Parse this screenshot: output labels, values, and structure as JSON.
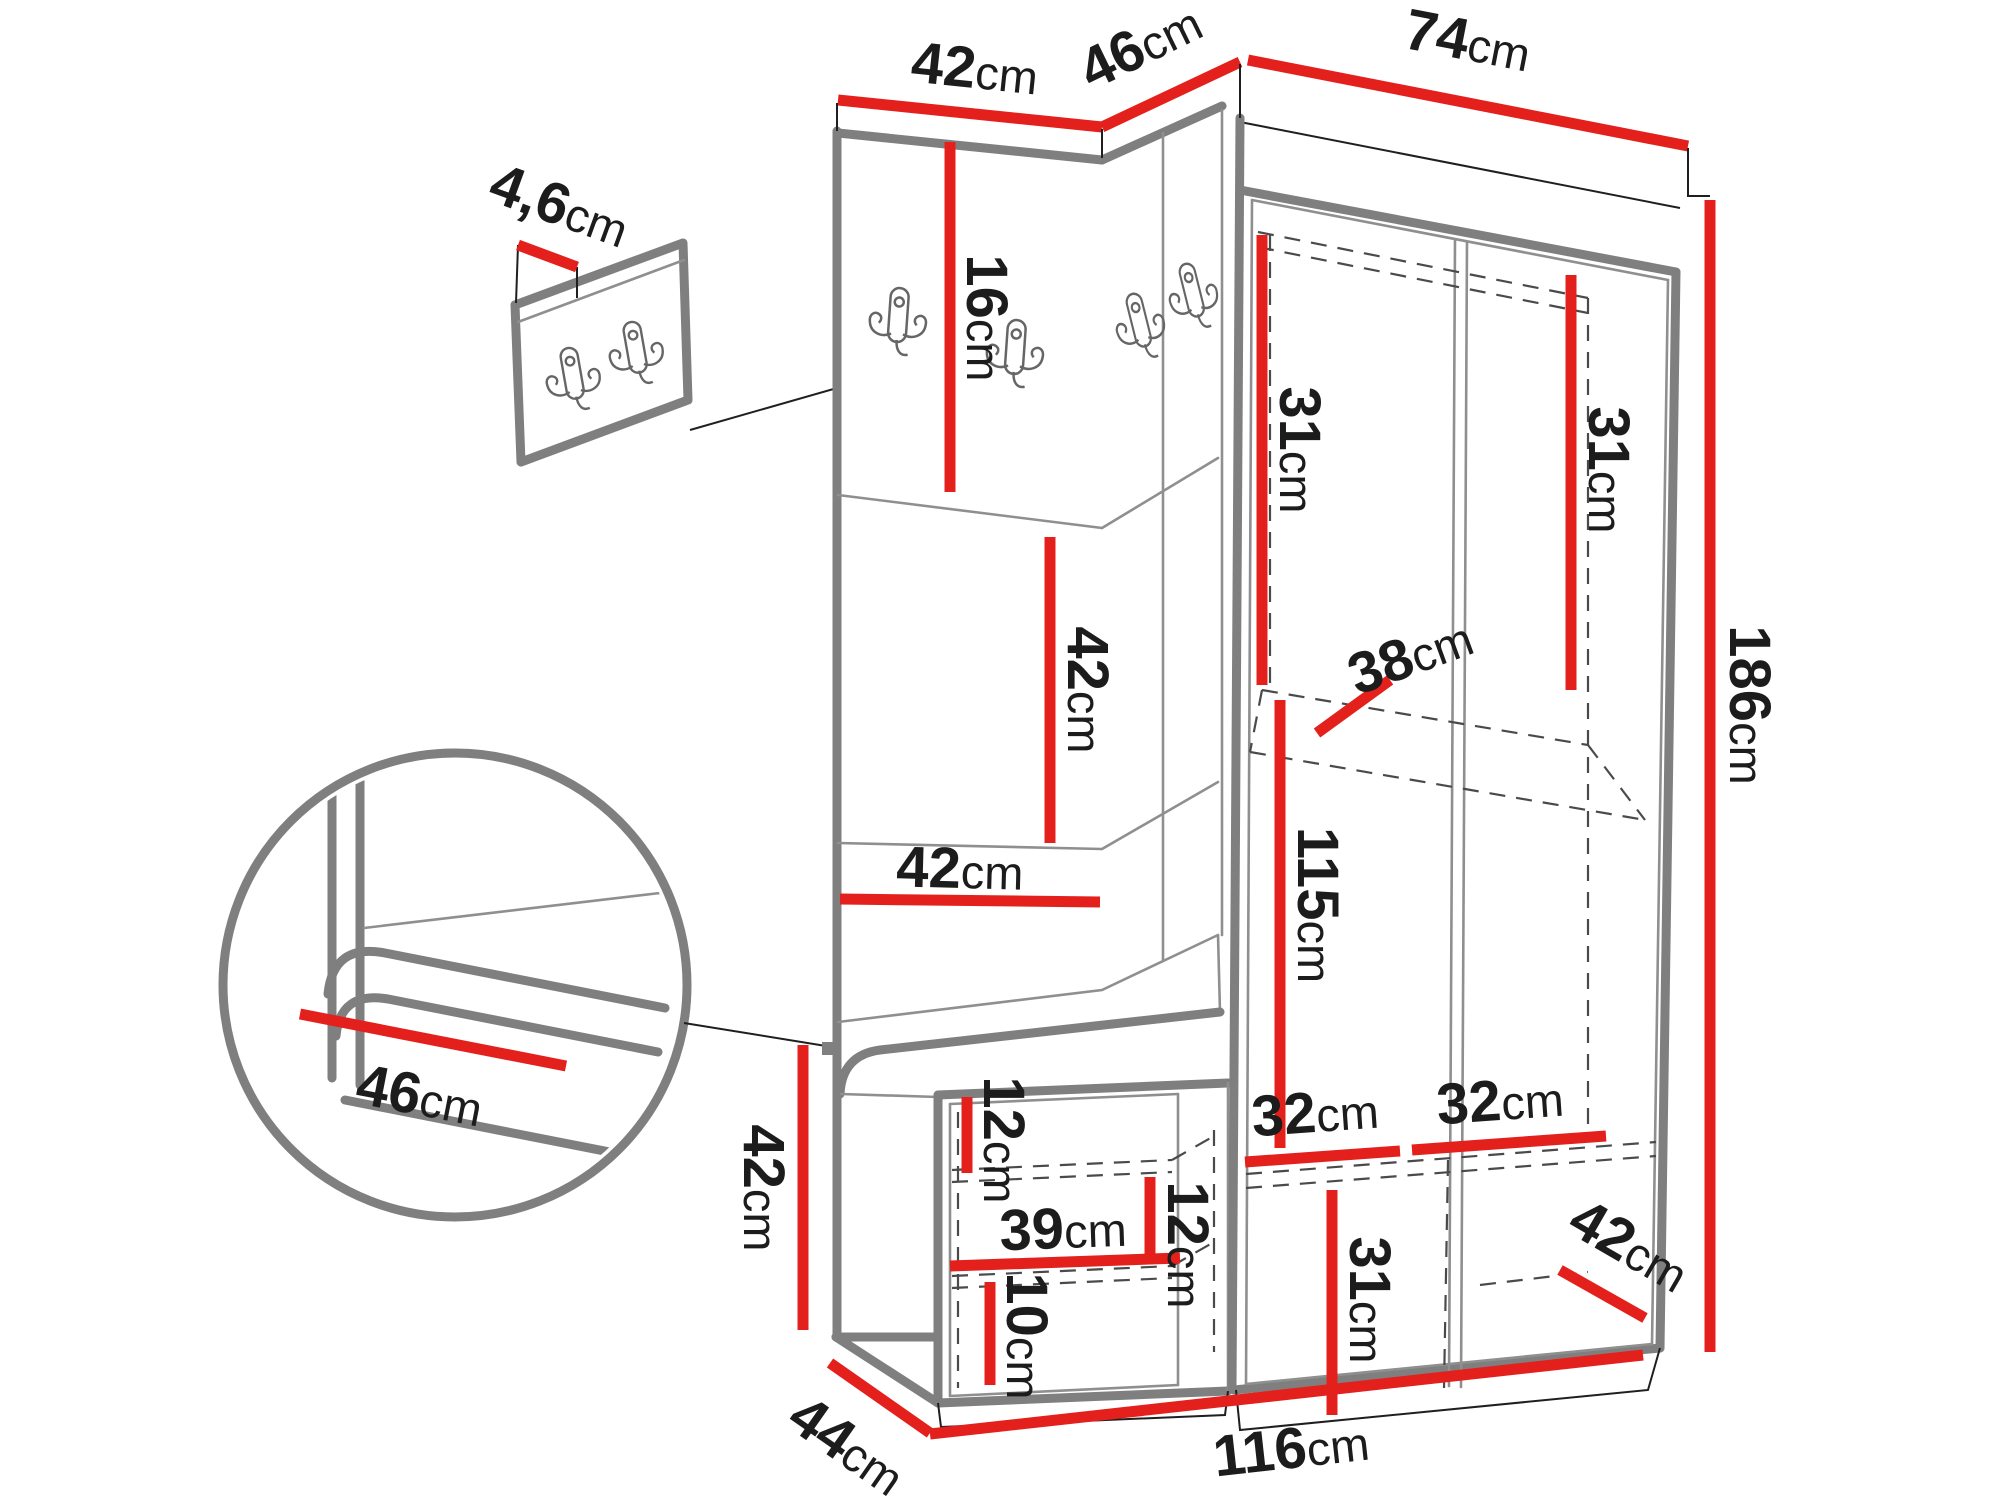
{
  "colors": {
    "dimension_red": "#e4201c",
    "outline_gray": "#7f7f7f",
    "line_black": "#1f1f1f",
    "text": "#1c1c1c",
    "background": "#ffffff"
  },
  "top_widths": {
    "panel": {
      "v": "42",
      "u": "cm"
    },
    "corner": {
      "v": "46",
      "u": "cm"
    },
    "wardrobe": {
      "v": "74",
      "u": "cm"
    }
  },
  "detail_wall_panel": {
    "thickness": {
      "v": "4,6",
      "u": "cm"
    }
  },
  "detail_bench_circle": {
    "seat_depth": {
      "v": "46",
      "u": "cm"
    }
  },
  "hook_panel": {
    "strip_height": {
      "v": "16",
      "u": "cm"
    },
    "segment_height": {
      "v": "42",
      "u": "cm"
    },
    "segment_width": {
      "v": "42",
      "u": "cm"
    }
  },
  "wardrobe": {
    "upper_left_height": {
      "v": "31",
      "u": "cm"
    },
    "upper_right_height": {
      "v": "31",
      "u": "cm"
    },
    "shelf_depth": {
      "v": "38",
      "u": "cm"
    },
    "hanging_height": {
      "v": "115",
      "u": "cm"
    },
    "bottom_left_width": {
      "v": "32",
      "u": "cm"
    },
    "bottom_right_width": {
      "v": "32",
      "u": "cm"
    },
    "bottom_height": {
      "v": "31",
      "u": "cm"
    },
    "depth": {
      "v": "42",
      "u": "cm"
    }
  },
  "bench": {
    "height": {
      "v": "42",
      "u": "cm"
    },
    "depth": {
      "v": "44",
      "u": "cm"
    },
    "top_offset": {
      "v": "12",
      "u": "cm"
    },
    "inner_width": {
      "v": "39",
      "u": "cm"
    },
    "shelf_gap": {
      "v": "12",
      "u": "cm"
    },
    "bottom_gap": {
      "v": "10",
      "u": "cm"
    }
  },
  "overall": {
    "total_height": {
      "v": "186",
      "u": "cm"
    },
    "total_width": {
      "v": "116",
      "u": "cm"
    }
  }
}
